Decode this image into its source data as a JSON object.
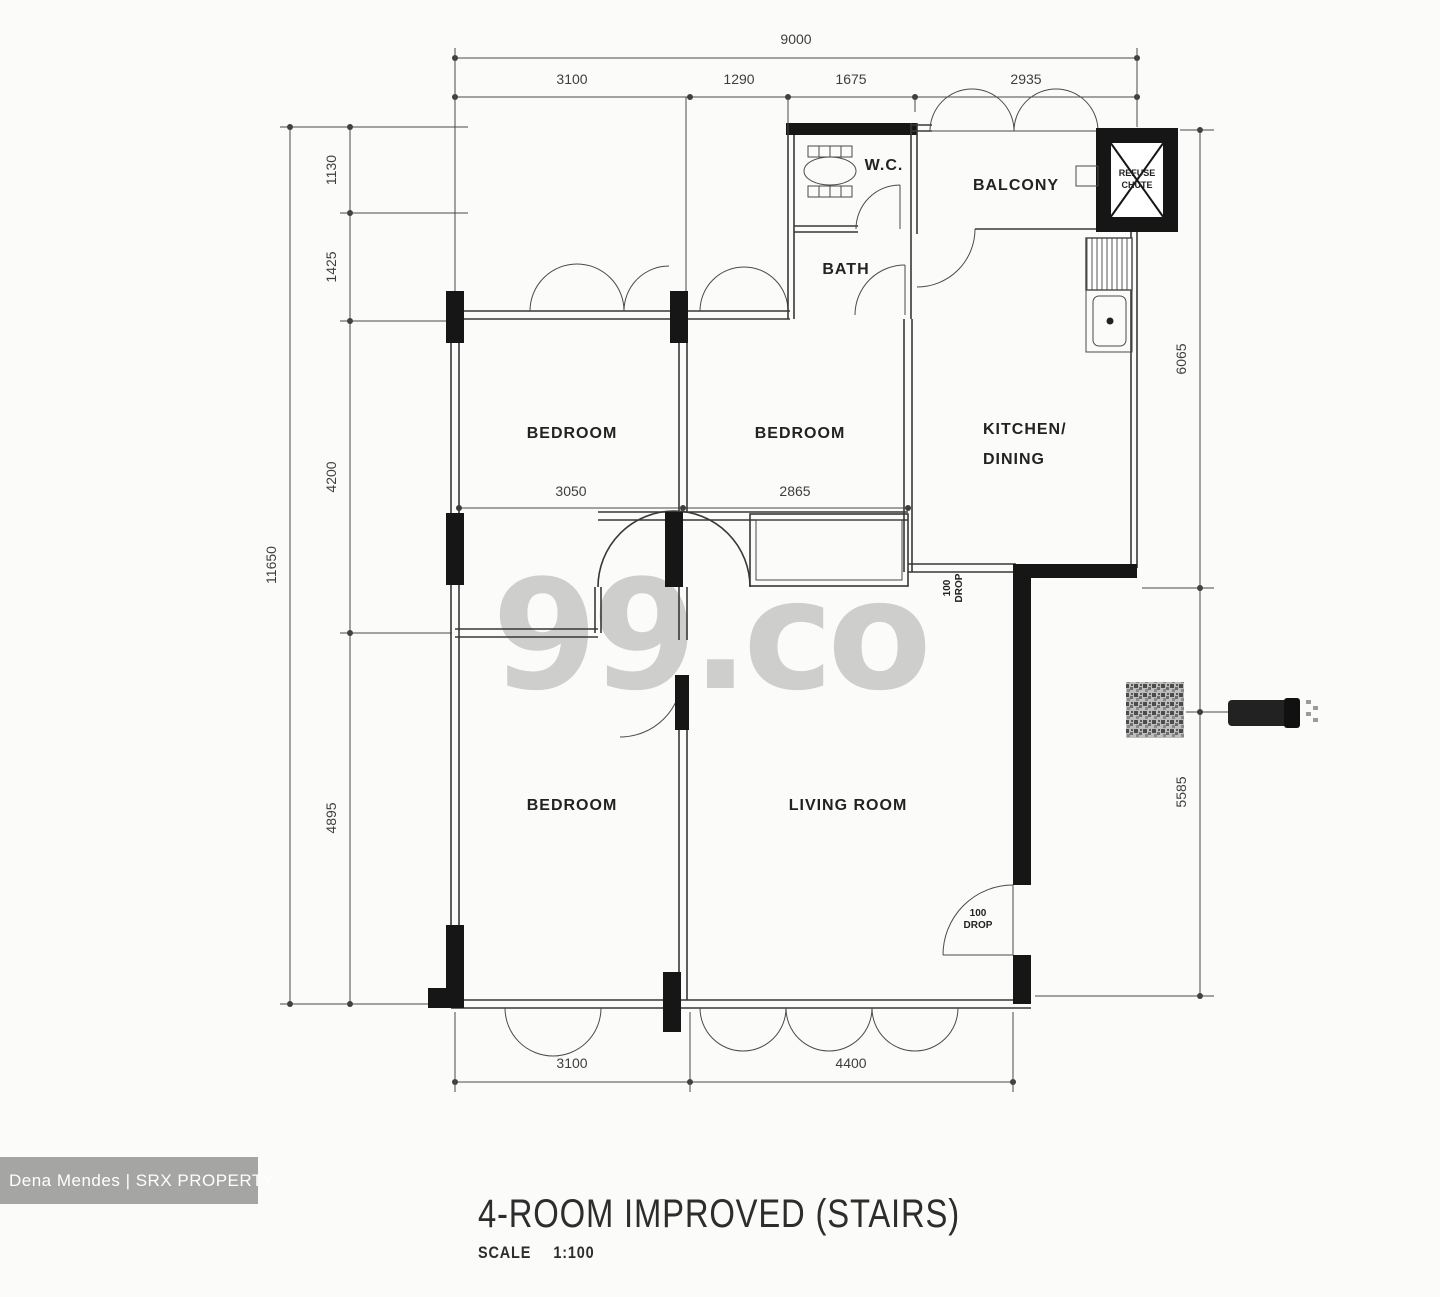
{
  "watermark": {
    "text": "99.co"
  },
  "badge": {
    "text": "Dena  Mendes | SRX PROPERTY"
  },
  "title": {
    "name": "4-ROOM IMPROVED (STAIRS)",
    "scale_label": "SCALE",
    "scale_value": "1:100"
  },
  "rooms": {
    "bedroom1": "BEDROOM",
    "bedroom2": "BEDROOM",
    "bedroom3": "BEDROOM",
    "kitchen_line1": "KITCHEN/",
    "kitchen_line2": "DINING",
    "living": "LIVING ROOM",
    "balcony": "BALCONY",
    "wc": "W.C.",
    "bath": "BATH",
    "refuse_line1": "REFUSE",
    "refuse_line2": "CHUTE"
  },
  "dims": {
    "top_total": "9000",
    "top_segments": [
      "3100",
      "1290",
      "1675",
      "2935"
    ],
    "left_total": "11650",
    "left_segments": [
      "1130",
      "1425",
      "4200",
      "4895"
    ],
    "right_segments": [
      "6065",
      "5585"
    ],
    "bottom_segments": [
      "3100",
      "4400"
    ],
    "internal_segments": [
      "3050",
      "2865"
    ],
    "drop_kitchen": [
      "100",
      "DROP"
    ],
    "drop_living": [
      "100",
      "DROP"
    ]
  }
}
